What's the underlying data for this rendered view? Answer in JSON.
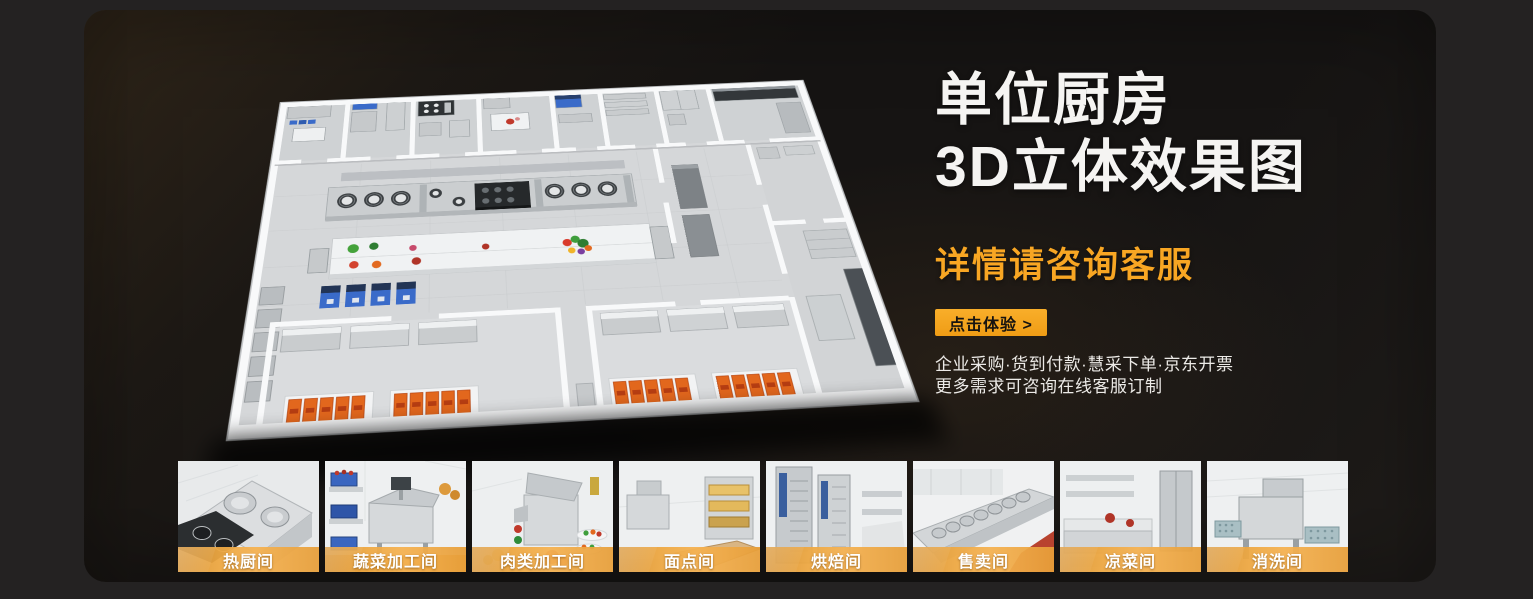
{
  "hero": {
    "title_line1": "单位厨房",
    "title_line2": "3D立体效果图",
    "subtitle": "详情请咨询客服",
    "cta_label": "点击体验 >",
    "info_line1": "企业采购·货到付款·慧采下单·京东开票",
    "info_line2": "更多需求可咨询在线客服订制"
  },
  "floorplan": {
    "description": "3D isometric render of a commercial unit kitchen floor plan with white walls, stainless cook line, prep counters, blue machines and serving rooms with orange food trays"
  },
  "thumbnails": {
    "items": [
      {
        "id": "hot-kitchen",
        "label": "热厨间"
      },
      {
        "id": "vegetable-processing",
        "label": "蔬菜加工间"
      },
      {
        "id": "meat-processing",
        "label": "肉类加工间"
      },
      {
        "id": "pastry-room",
        "label": "面点间"
      },
      {
        "id": "baking-room",
        "label": "烘焙间"
      },
      {
        "id": "sales-room",
        "label": "售卖间"
      },
      {
        "id": "cold-dish-room",
        "label": "凉菜间"
      },
      {
        "id": "washing-room",
        "label": "消洗间"
      }
    ]
  },
  "colors": {
    "accent_orange": "#F2A531",
    "panel_background": "#161413",
    "outer_background": "#242222",
    "title_white": "#F5F4F2"
  }
}
